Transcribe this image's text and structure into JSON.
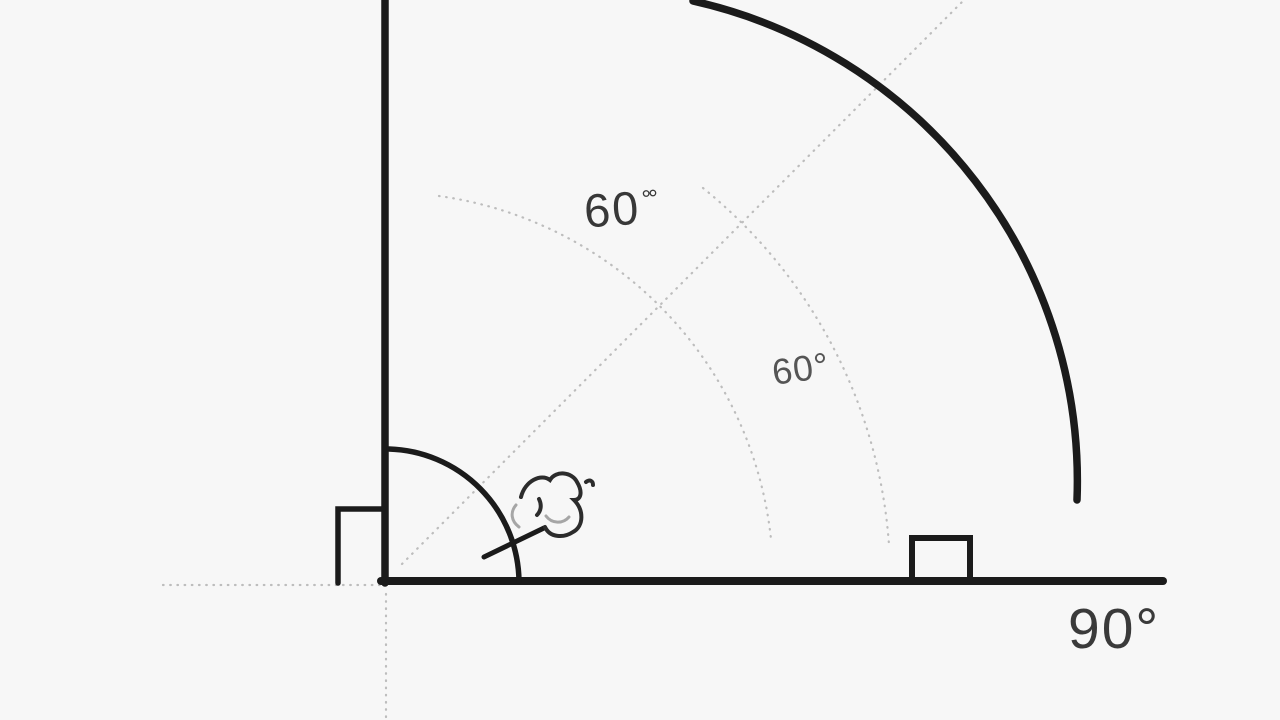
{
  "diagram": {
    "title": "right-angle geometry diagram",
    "colors": {
      "background": "#f7f7f7",
      "ink": "#1b1b1b",
      "guide_dots": "#bdbdbd",
      "label_text": "#3a3a3a"
    },
    "angle_labels": {
      "outer": {
        "value": "60",
        "degree_mark": "°°"
      },
      "inner": {
        "value": "60°"
      },
      "base_right": {
        "value": "90°"
      }
    }
  }
}
